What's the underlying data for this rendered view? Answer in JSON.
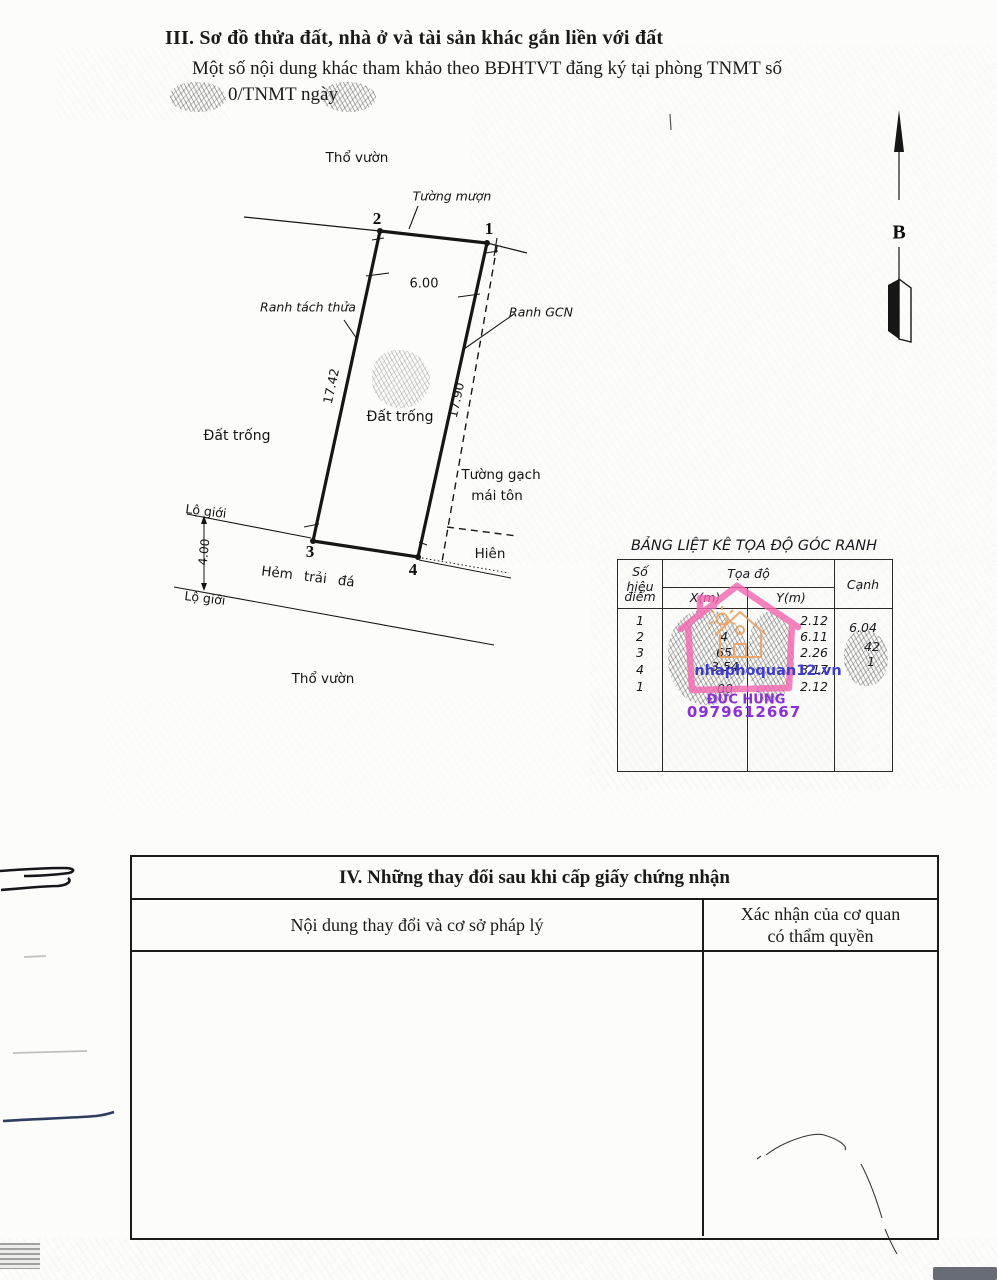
{
  "section3": {
    "title": "III. Sơ đồ thửa đất, nhà ở và tài sản khác gắn liền với đất",
    "subtitle_line1": "Một số nội dung khác tham khảo theo BĐHTVT đăng ký tại phòng TNMT số",
    "subtitle_line2_visible": "0/TNMT ngày"
  },
  "diagram": {
    "labels": {
      "tho_vuon_top": "Thổ vườn",
      "tuong_muon": "Tường mượn",
      "ranh_tach_thua": "Ranh tách thửa",
      "ranh_gcn": "Ranh GCN",
      "dat_trong_inside": "Đất trống",
      "dat_trong_outside": "Đất trống",
      "tuong_gach_line1": "Tường gạch",
      "tuong_gach_line2": "mái tôn",
      "hien": "Hiên",
      "lo_gioi_1": "Lộ giới",
      "lo_gioi_2": "Lộ giới",
      "hem_trai_da": "Hẻm trải đá",
      "tho_vuon_bottom": "Thổ vườn",
      "north_letter": "B"
    },
    "points": {
      "p1": "1",
      "p2": "2",
      "p3": "3",
      "p4": "4"
    },
    "dims": {
      "top": "6.00",
      "left": "17.42",
      "right": "17.90",
      "road_width": "4.00"
    }
  },
  "coord_table": {
    "title": "BẢNG LIỆT KÊ TỌA ĐỘ GÓC RANH",
    "header": {
      "point_line1": "Số hiệu",
      "point_line2": "điểm",
      "toado": "Tọa độ",
      "x": "X(m)",
      "y": "Y(m)",
      "canh": "Cạnh"
    },
    "rows": [
      {
        "stt": "1",
        "x": "",
        "y": "2.12"
      },
      {
        "stt": "2",
        "x": "4",
        "y": "6.11"
      },
      {
        "stt": "3",
        "x": "65",
        "y": "2.26"
      },
      {
        "stt": "4",
        "x": "3.54",
        "y": "8.17"
      },
      {
        "stt": "1",
        "x": "00",
        "y": "2.12"
      }
    ],
    "canh_values": [
      "6.04",
      "42",
      "1"
    ]
  },
  "watermark": {
    "site": "nhaphoquan12.vn",
    "name": "ĐỨC HÙNG",
    "phone": "0979612667",
    "pink": "#f368b1",
    "orange": "#eda05f",
    "blue": "#3d3ccc",
    "purple": "#8b2fd6"
  },
  "section4": {
    "title": "IV. Những thay đổi sau khi cấp giấy chứng nhận",
    "col_left": "Nội dung thay đổi và cơ sở pháp lý",
    "col_right_line1": "Xác nhận của cơ quan",
    "col_right_line2": "có thẩm quyền"
  }
}
